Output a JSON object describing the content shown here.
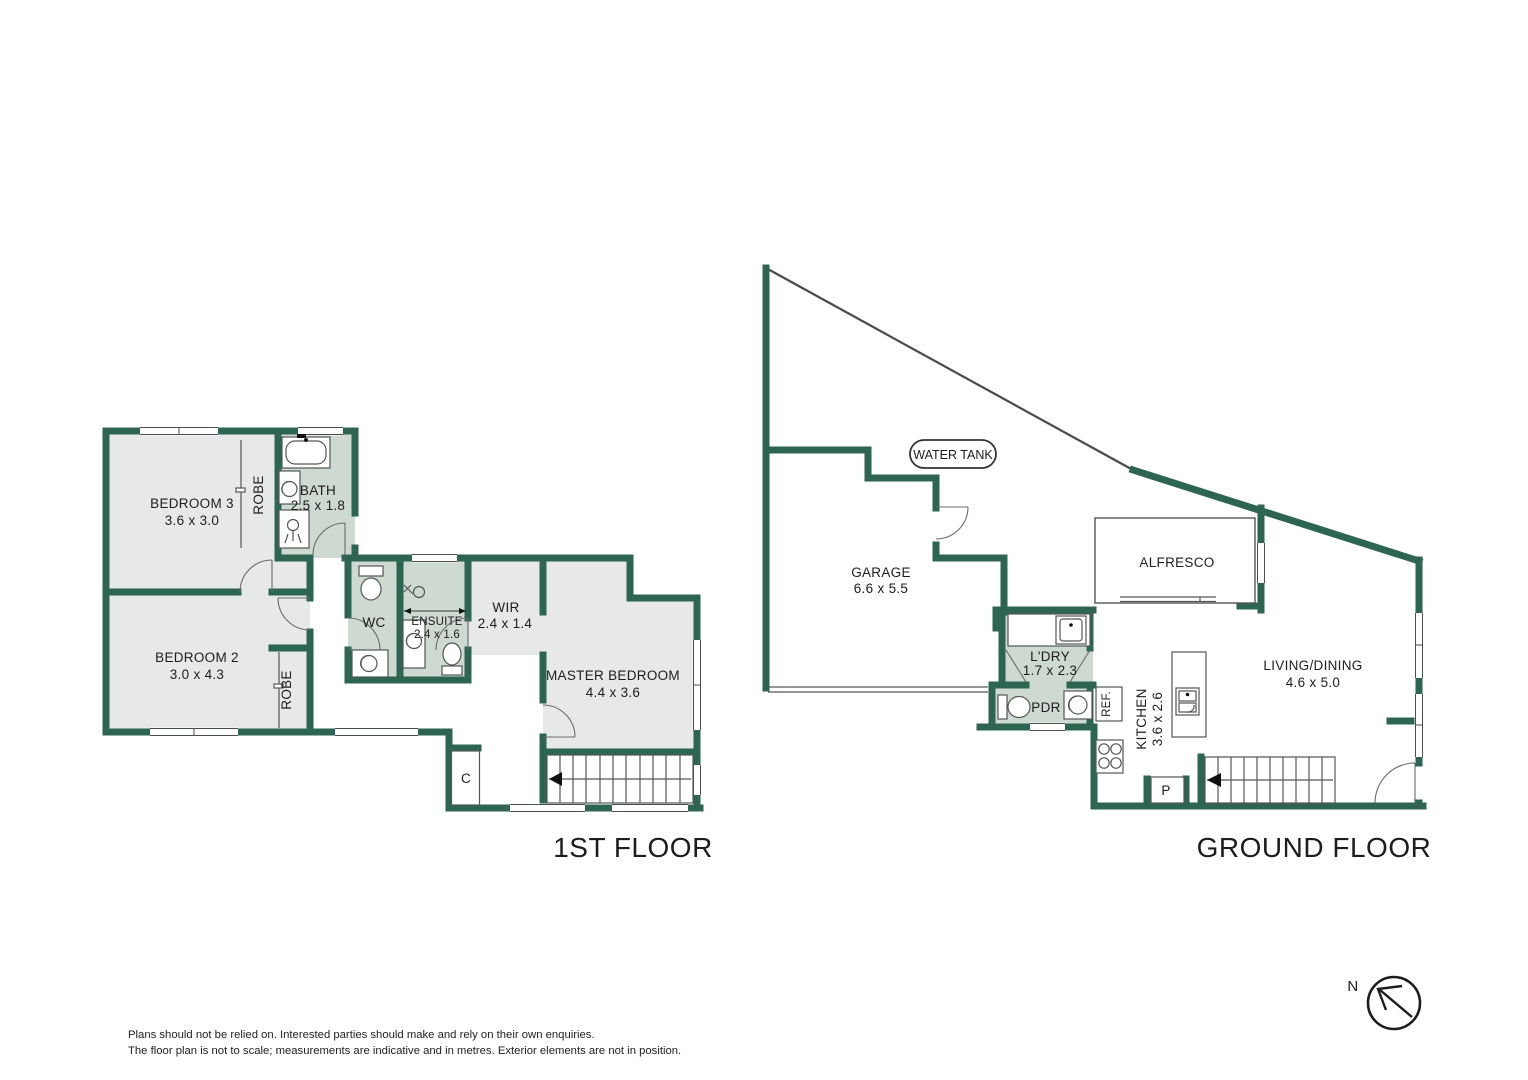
{
  "titles": {
    "first_floor": "1ST FLOOR",
    "ground_floor": "GROUND FLOOR"
  },
  "first_floor": {
    "bedroom3": {
      "name": "BEDROOM 3",
      "dims": "3.6 x 3.0"
    },
    "bedroom2": {
      "name": "BEDROOM 2",
      "dims": "3.0 x 4.3"
    },
    "bath": {
      "name": "BATH",
      "dims": "2.5 x 1.8"
    },
    "wc": {
      "name": "WC"
    },
    "ensuite": {
      "name": "ENSUITE",
      "dims": "2.4 x 1.6"
    },
    "wir": {
      "name": "WIR",
      "dims": "2.4 x 1.4"
    },
    "master": {
      "name": "MASTER BEDROOM",
      "dims": "4.4 x 3.6"
    },
    "robe3": "ROBE",
    "robe2": "ROBE",
    "closet": "C"
  },
  "ground_floor": {
    "garage": {
      "name": "GARAGE",
      "dims": "6.6 x 5.5"
    },
    "water_tank": "WATER TANK",
    "alfresco": {
      "name": "ALFRESCO"
    },
    "laundry": {
      "name": "L'DRY",
      "dims": "1.7 x 2.3"
    },
    "pdr": {
      "name": "PDR"
    },
    "ref": "REF.",
    "kitchen": {
      "name": "KITCHEN",
      "dims": "3.6 x 2.6"
    },
    "living": {
      "name": "LIVING/DINING",
      "dims": "4.6 x 5.0"
    },
    "pantry": "P"
  },
  "compass": {
    "north_label": "N"
  },
  "disclaimer": {
    "line1": "Plans should not be relied on. Interested parties should make and rely on their own enquiries.",
    "line2": "The floor plan is not to scale; measurements are indicative and in metres. Exterior elements are not in position."
  },
  "colors": {
    "wall": "#2e6452",
    "wet_area": "#cdd9d1",
    "room": "#e7e8e9"
  }
}
